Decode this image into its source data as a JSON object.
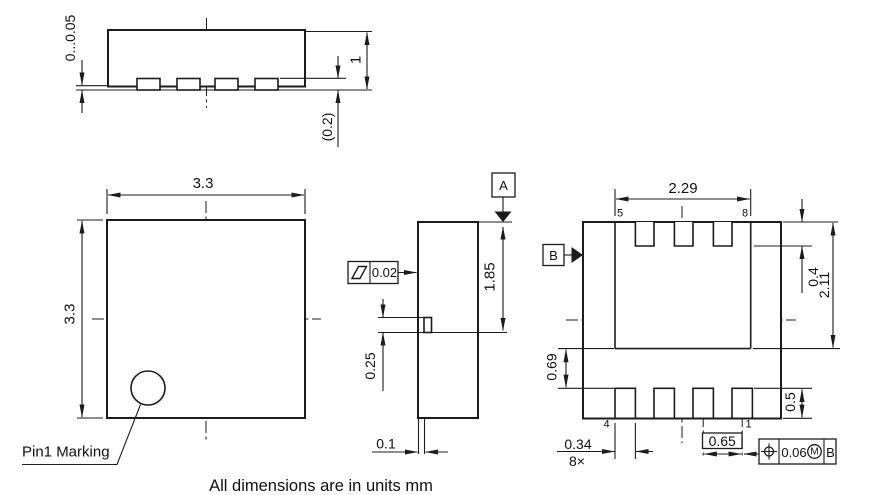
{
  "drawing": {
    "note": "All dimensions are in units mm",
    "side_view": {
      "standoff": "0...0.05",
      "body_height": "1",
      "lead_standoff": "(0.2)"
    },
    "top_view": {
      "width": "3.3",
      "height": "3.3",
      "pin1_label": "Pin1 Marking"
    },
    "front_view": {
      "datum_a": "A",
      "flatness_tol": "0.02",
      "height_to_lead": "1.85",
      "lead_height": "0.25",
      "lead_thickness": "0.1"
    },
    "bottom_view": {
      "datum_b": "B",
      "pad_width": "2.29",
      "pad_length": "2.11",
      "lead_length_top": "0.4",
      "pad_to_lead_gap": "0.69",
      "lead_length_bottom": "0.5",
      "lead_width": "0.34",
      "lead_count": "8×",
      "pitch": "0.65",
      "pin_labels": {
        "pin1": "1",
        "pin4": "4",
        "pin5": "5",
        "pin8": "8"
      },
      "position_frame": {
        "tolerance": "0.06",
        "modifier": "M",
        "datum_ref": "B"
      }
    }
  }
}
